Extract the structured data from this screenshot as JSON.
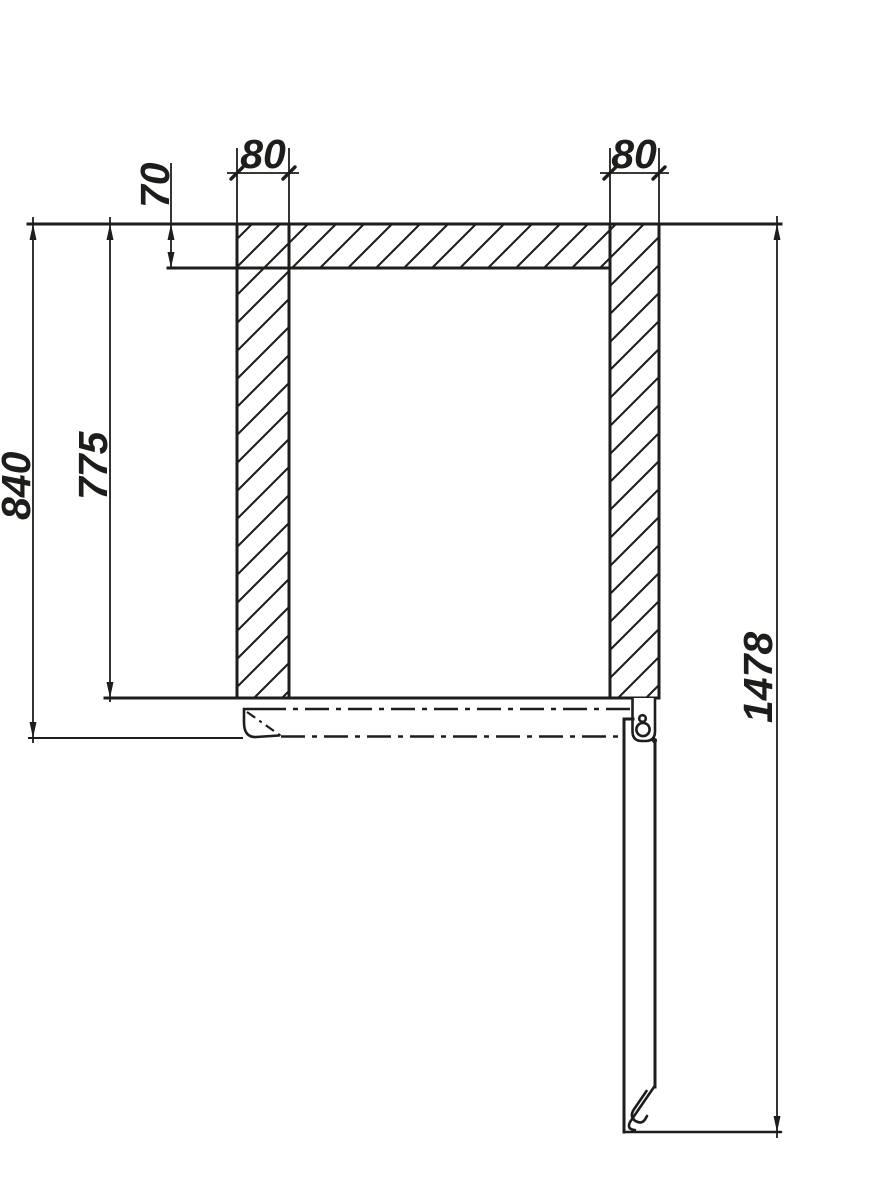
{
  "drawing": {
    "kind": "technical-section-drawing",
    "labels": {
      "width_left": "80",
      "width_right": "80",
      "top_thickness": "70",
      "inner_height": "775",
      "outer_height": "840",
      "total_height": "1478"
    },
    "colors": {
      "line": "#1d1d1b",
      "background": "#ffffff"
    }
  }
}
